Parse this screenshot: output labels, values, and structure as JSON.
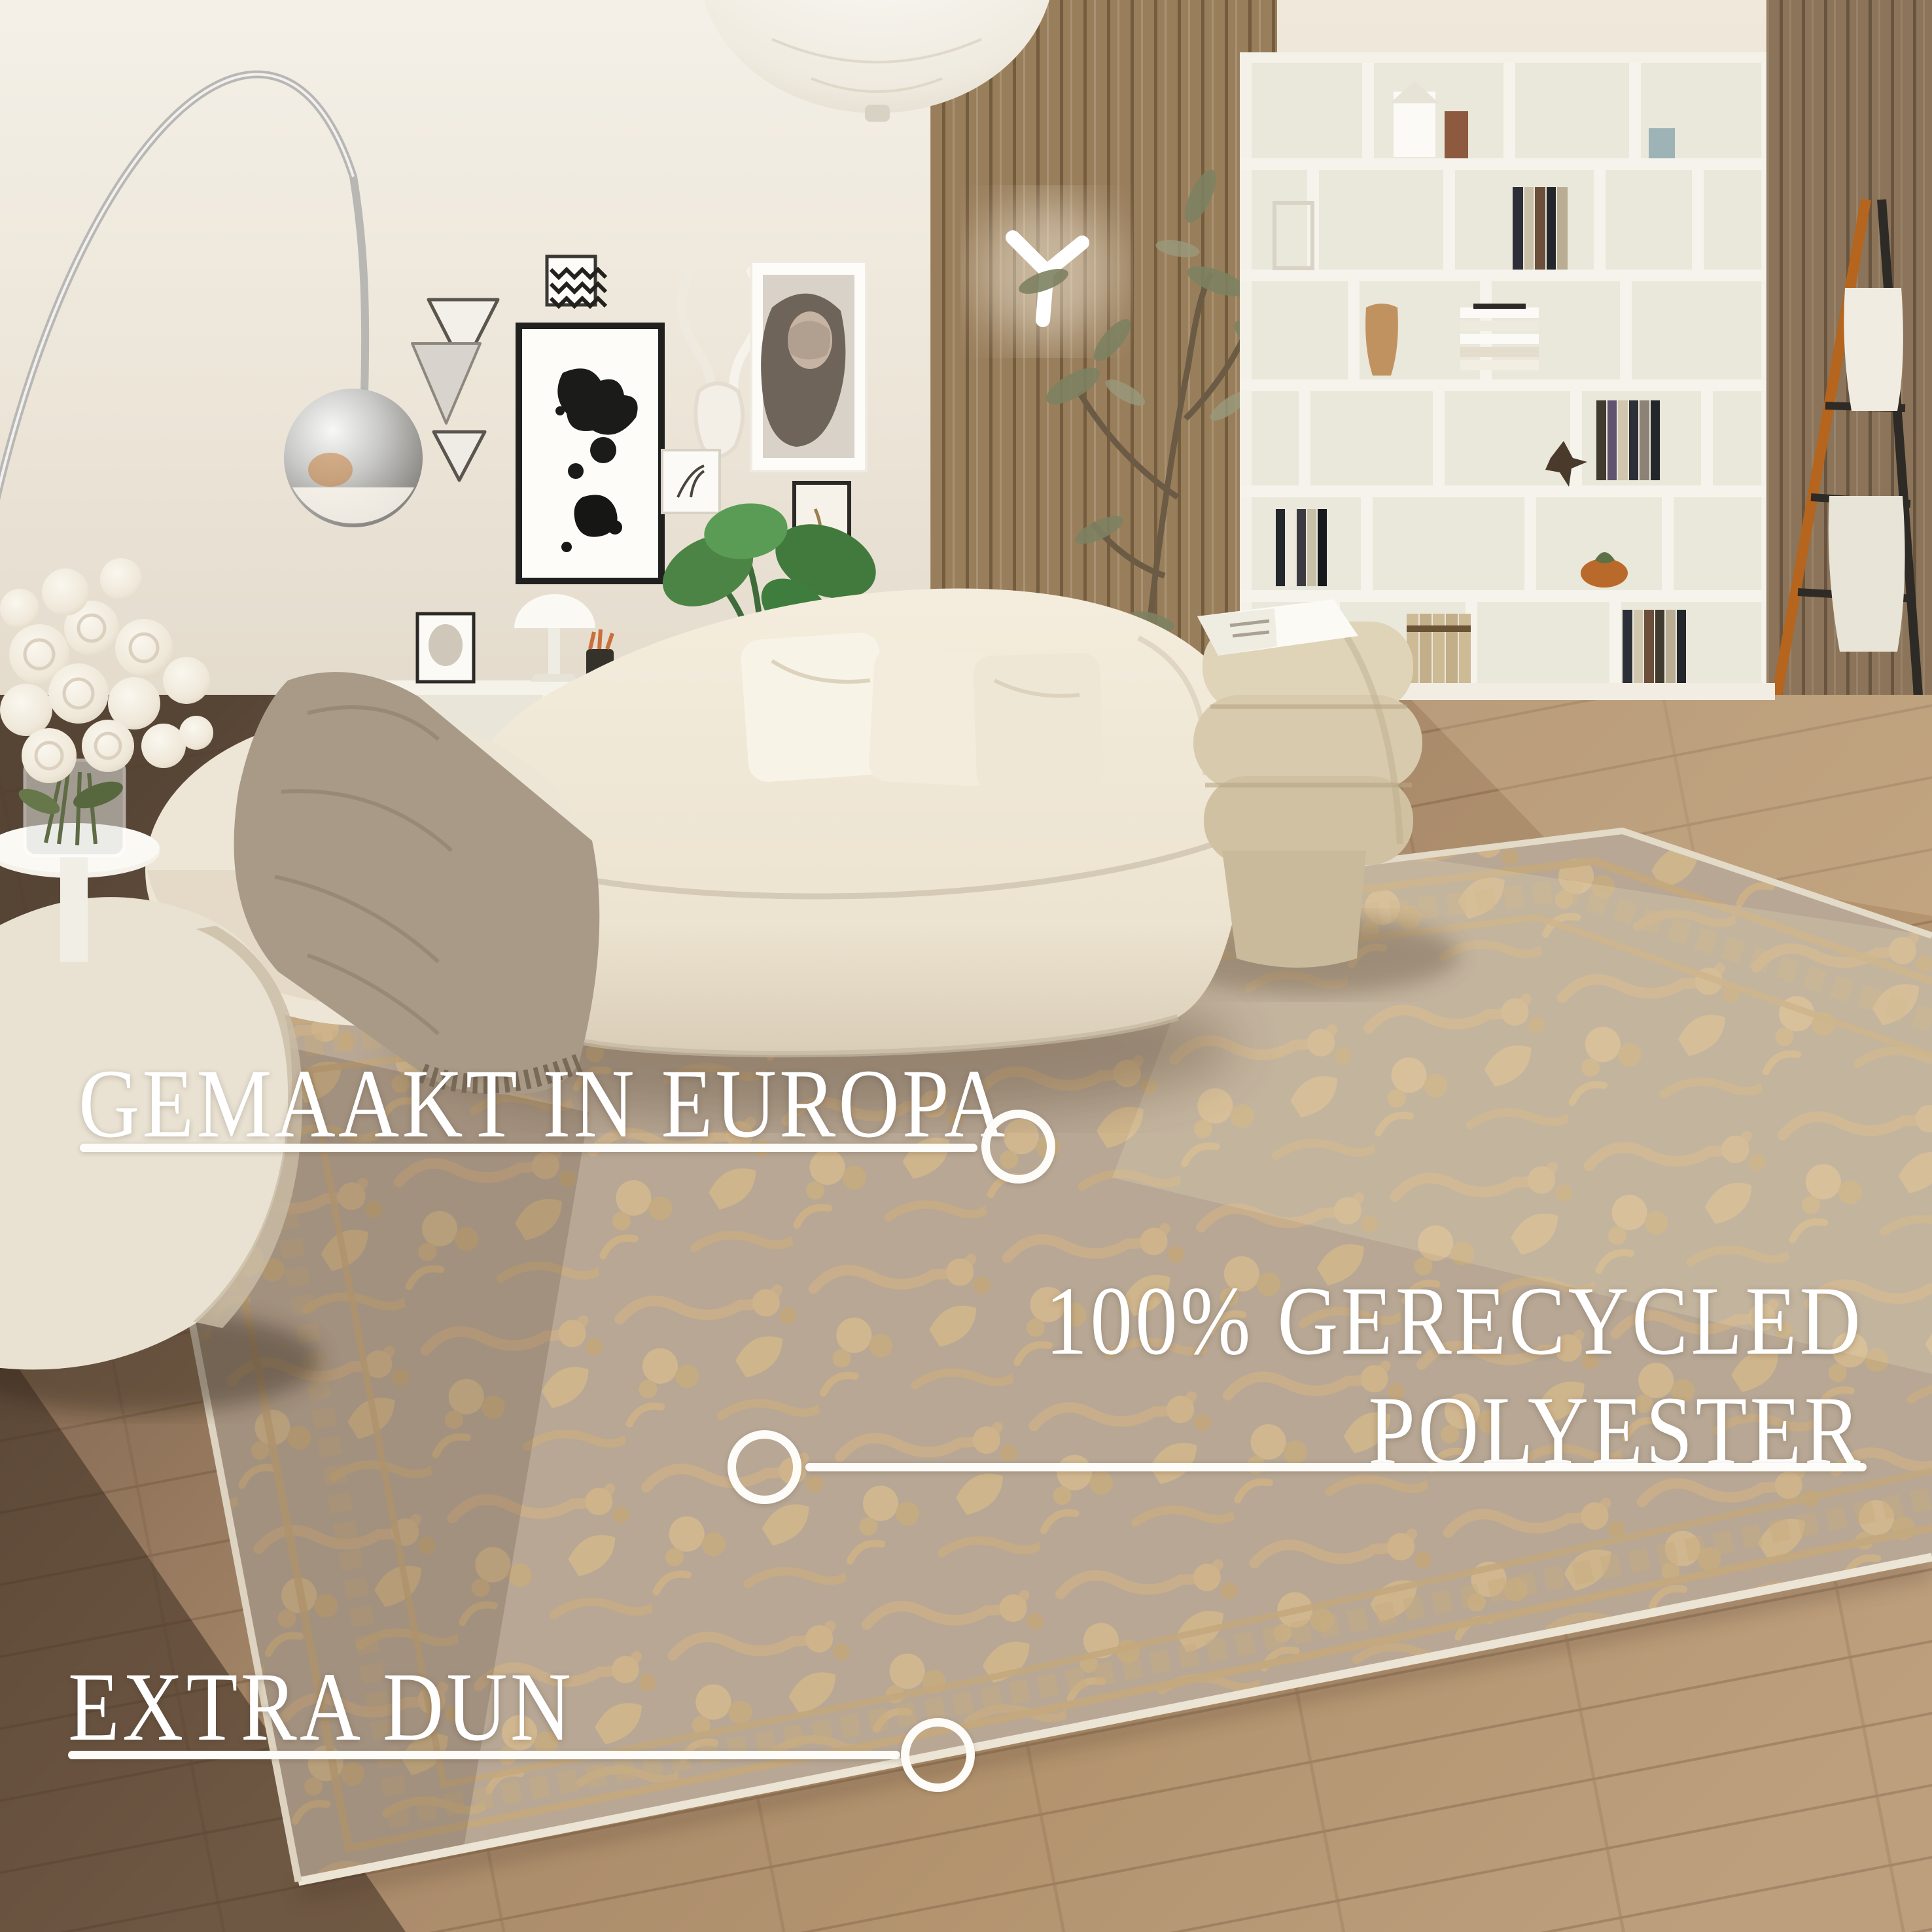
{
  "page": {
    "title": "Vloerkleed productfoto woonkamer"
  },
  "annotations": {
    "made_in": {
      "label": "GEMAAKT IN EUROPA",
      "icon": "callout-circle"
    },
    "material": {
      "line1": "100% GERECYCLED",
      "line2": "POLYESTER",
      "icon": "callout-circle"
    },
    "thin": {
      "label": "EXTRA DUN",
      "icon": "callout-circle"
    }
  },
  "style": {
    "annotation_color": "#ffffff",
    "wall": "#efe9de",
    "wood_panel": "#aa8d68",
    "floor_light": "#bb9d7b",
    "floor_dark": "#5a473a",
    "rug_base": "#b7a794",
    "rug_motif": "#cfb48c",
    "rug_binding": "#e6ddcb",
    "sofa": "#f1ead9",
    "pouf": "#dcd0b4",
    "blanket": "#a89a86"
  }
}
